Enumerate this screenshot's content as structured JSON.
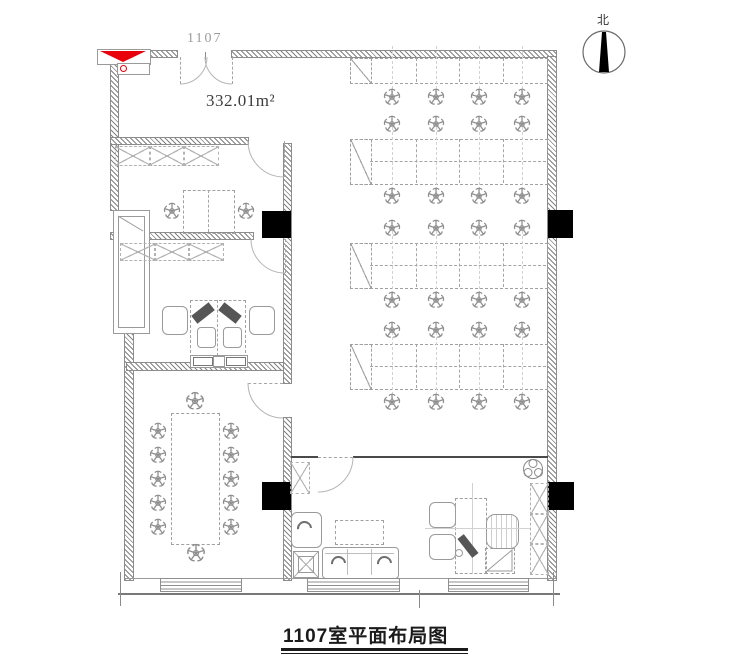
{
  "labels": {
    "entrance_room_number": "1107",
    "area": "332.01m²",
    "north": "北",
    "title": "1107室平面布局图"
  },
  "colors": {
    "line": "#9a9a9a",
    "wall_hatch": "#828282",
    "column": "#000000",
    "accent_red": "#e8000a",
    "text_dark": "#1a1a1a",
    "text_gray": "#9b9b9b"
  },
  "floorplan": {
    "workstation_count": 28,
    "meeting_seats": 12,
    "benches": [
      {
        "x": 350,
        "y": 58,
        "w": 196,
        "h": 24,
        "double": false
      },
      {
        "x": 350,
        "y": 139,
        "w": 196,
        "h": 44,
        "double": true
      },
      {
        "x": 350,
        "y": 243,
        "w": 196,
        "h": 44,
        "double": true
      },
      {
        "x": 350,
        "y": 344,
        "w": 196,
        "h": 44,
        "double": true
      }
    ],
    "chair_columns": [
      392,
      436,
      479,
      522
    ],
    "chair_rows": [
      97,
      124,
      196,
      228,
      300,
      330,
      402
    ],
    "meeting": {
      "table": {
        "x": 171,
        "y": 413,
        "w": 47,
        "h": 130
      },
      "left_x": 158,
      "right_x": 231,
      "side_ys": [
        431,
        455,
        479,
        503,
        527
      ],
      "end_chairs": [
        {
          "x": 195,
          "y": 401
        },
        {
          "x": 196,
          "y": 553
        }
      ]
    },
    "room1_chairs": [
      {
        "x": 172,
        "y": 211
      },
      {
        "x": 246,
        "y": 211
      }
    ]
  }
}
